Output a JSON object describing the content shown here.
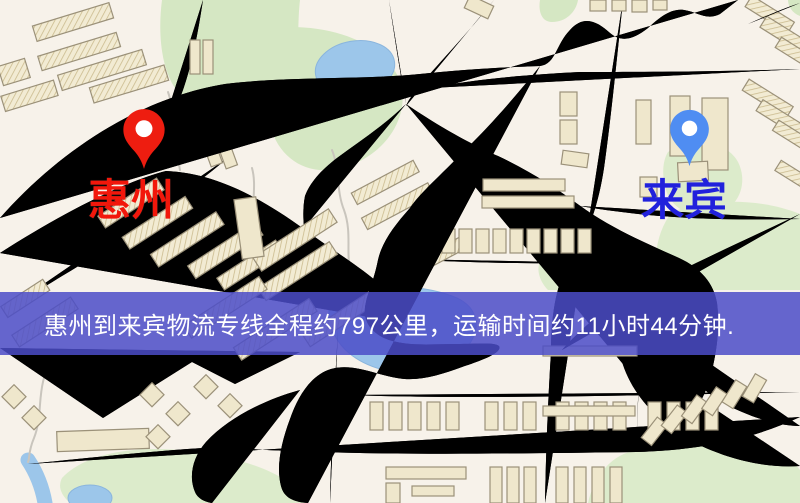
{
  "map": {
    "origin": {
      "label": "惠州",
      "label_color": "#f2170b",
      "pin_color": "#ee1d10"
    },
    "destination": {
      "label": "来宾",
      "label_color": "#2121dc",
      "pin_color": "#4f8df2"
    },
    "banner": {
      "text": "惠州到来宾物流专线全程约797公里，运输时间约11小时44分钟.",
      "background": "#4b4cc8",
      "text_color": "#ffffff"
    },
    "colors": {
      "road": "#f3ca68",
      "road_casing": "#dfa952",
      "water": "#9cc6ea",
      "park": "#d5e7c3",
      "building": "#efe7cc",
      "railway": "#2e2c2a",
      "background": "#f7f2ea"
    }
  }
}
